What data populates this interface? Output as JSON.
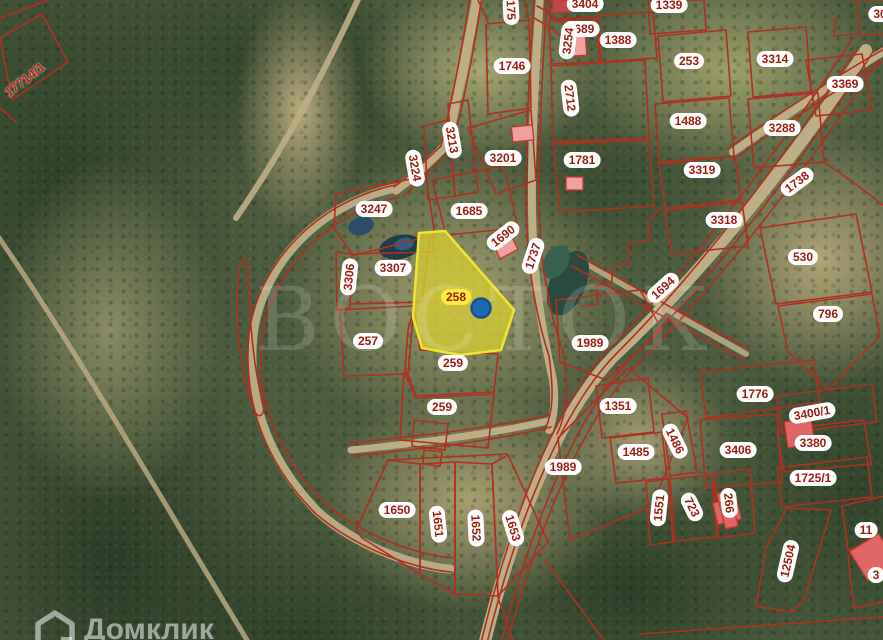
{
  "watermark": {
    "text": "ВОСТОК"
  },
  "brand": {
    "name": "Домклик",
    "icon": "domclick-house-icon"
  },
  "map": {
    "selected_parcel": {
      "id": "258",
      "has_marker": true
    },
    "colors": {
      "boundary": "#b0301f",
      "label_text": "#9c1b10",
      "label_bg": "#ffffff",
      "selected_label_bg": "#ffe93d",
      "selected_parcel_fill": "#cfc735",
      "selected_parcel_stroke": "#f2e430",
      "marker_fill": "#1d6ab2",
      "marker_stroke": "#14518f",
      "building_fill": "#efa0a0",
      "building_fill_dark": "#e06666",
      "building_stroke": "#c23b2a",
      "road_fill": "#bfae85"
    },
    "labels": [
      {
        "t": "17714/1",
        "x": 25,
        "y": 80,
        "r": -38,
        "s": "plain"
      },
      {
        "t": "175",
        "x": 511,
        "y": 10,
        "r": 87
      },
      {
        "t": "3404",
        "x": 585,
        "y": 4
      },
      {
        "t": "1339",
        "x": 669,
        "y": 5
      },
      {
        "t": "1689",
        "x": 581,
        "y": 29
      },
      {
        "t": "3254",
        "x": 568,
        "y": 41,
        "r": -83
      },
      {
        "t": "1388",
        "x": 618,
        "y": 40
      },
      {
        "t": "253",
        "x": 689,
        "y": 61
      },
      {
        "t": "3314",
        "x": 775,
        "y": 59
      },
      {
        "t": "30",
        "x": 880,
        "y": 14
      },
      {
        "t": "3369",
        "x": 845,
        "y": 84
      },
      {
        "t": "1746",
        "x": 512,
        "y": 66
      },
      {
        "t": "2712",
        "x": 570,
        "y": 98,
        "r": 83
      },
      {
        "t": "1488",
        "x": 688,
        "y": 121
      },
      {
        "t": "3288",
        "x": 782,
        "y": 128
      },
      {
        "t": "1738",
        "x": 797,
        "y": 182,
        "r": -37
      },
      {
        "t": "3213",
        "x": 452,
        "y": 140,
        "r": 80
      },
      {
        "t": "3224",
        "x": 415,
        "y": 168,
        "r": 80
      },
      {
        "t": "3201",
        "x": 503,
        "y": 158
      },
      {
        "t": "1781",
        "x": 582,
        "y": 160
      },
      {
        "t": "3319",
        "x": 702,
        "y": 170
      },
      {
        "t": "3318",
        "x": 724,
        "y": 220
      },
      {
        "t": "530",
        "x": 803,
        "y": 257
      },
      {
        "t": "796",
        "x": 828,
        "y": 314
      },
      {
        "t": "1694",
        "x": 663,
        "y": 288,
        "r": -42
      },
      {
        "t": "3247",
        "x": 374,
        "y": 209
      },
      {
        "t": "1685",
        "x": 469,
        "y": 211
      },
      {
        "t": "1690",
        "x": 503,
        "y": 236,
        "r": -38
      },
      {
        "t": "1737",
        "x": 533,
        "y": 256,
        "r": -72
      },
      {
        "t": "3307",
        "x": 393,
        "y": 268
      },
      {
        "t": "3306",
        "x": 349,
        "y": 277,
        "r": -84
      },
      {
        "t": "257",
        "x": 368,
        "y": 341
      },
      {
        "t": "258",
        "x": 456,
        "y": 297,
        "s": "sel"
      },
      {
        "t": "259",
        "x": 453,
        "y": 363
      },
      {
        "t": "1989",
        "x": 590,
        "y": 343
      },
      {
        "t": "259",
        "x": 442,
        "y": 407
      },
      {
        "t": "1351",
        "x": 618,
        "y": 406
      },
      {
        "t": "1989",
        "x": 563,
        "y": 467
      },
      {
        "t": "1650",
        "x": 397,
        "y": 510
      },
      {
        "t": "1651",
        "x": 438,
        "y": 524,
        "r": 84
      },
      {
        "t": "1652",
        "x": 476,
        "y": 528,
        "r": 87
      },
      {
        "t": "1653",
        "x": 513,
        "y": 528,
        "r": 73
      },
      {
        "t": "1776",
        "x": 755,
        "y": 394
      },
      {
        "t": "3400/1",
        "x": 812,
        "y": 413,
        "r": -10
      },
      {
        "t": "3380",
        "x": 813,
        "y": 443
      },
      {
        "t": "1485",
        "x": 636,
        "y": 452
      },
      {
        "t": "1486",
        "x": 675,
        "y": 441,
        "r": 64
      },
      {
        "t": "3406",
        "x": 738,
        "y": 450
      },
      {
        "t": "1725/1",
        "x": 813,
        "y": 478
      },
      {
        "t": "1551",
        "x": 659,
        "y": 508,
        "r": -84
      },
      {
        "t": "723",
        "x": 692,
        "y": 507,
        "r": 64
      },
      {
        "t": "266",
        "x": 729,
        "y": 503,
        "r": 84
      },
      {
        "t": "12504",
        "x": 788,
        "y": 561,
        "r": -77
      },
      {
        "t": "11",
        "x": 866,
        "y": 530
      },
      {
        "t": "3",
        "x": 876,
        "y": 575
      }
    ]
  }
}
